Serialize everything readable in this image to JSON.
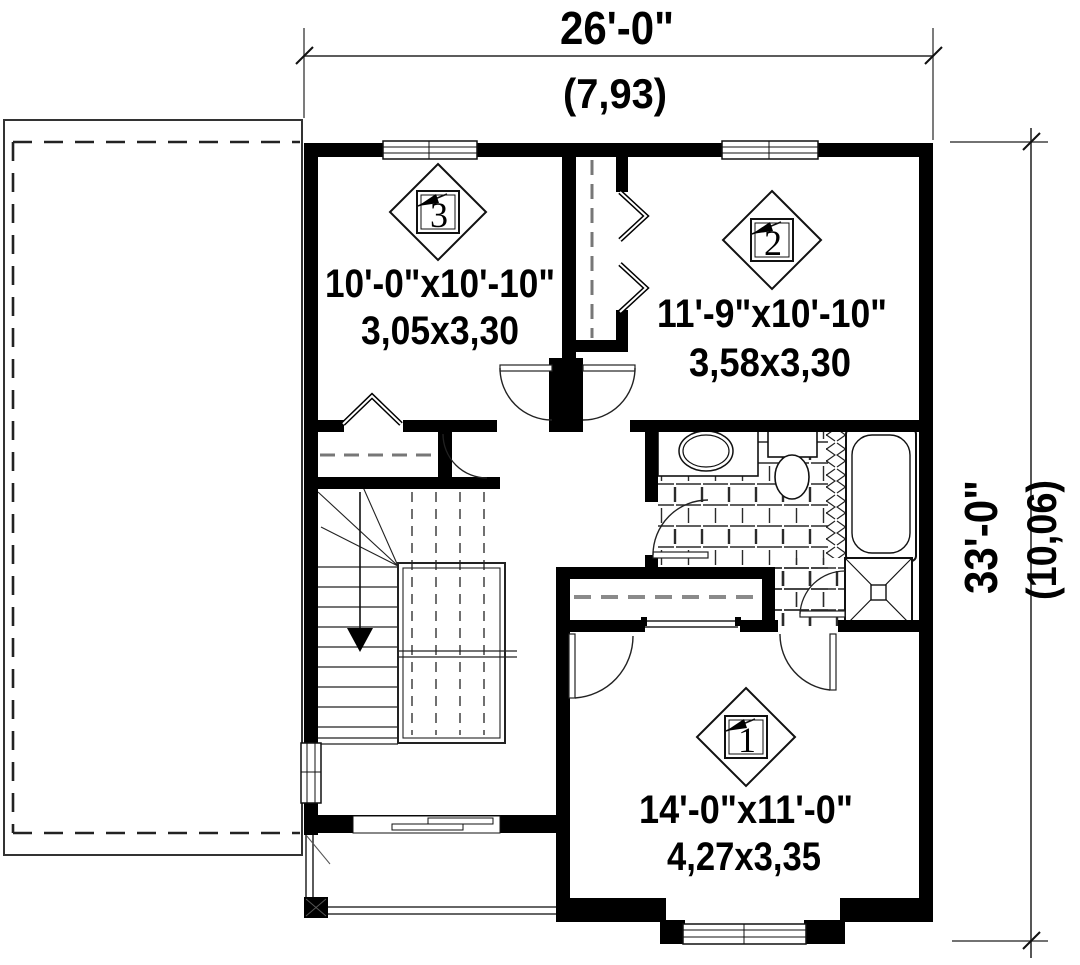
{
  "plan": {
    "title": "second-floor-plan",
    "dimensions": {
      "top_imperial": "26'-0\"",
      "top_metric": "(7,93)",
      "right_imperial": "33'-0\"",
      "right_metric": "(10,06)"
    },
    "rooms": [
      {
        "number": "1",
        "imperial": "14'-0\"x11'-0\"",
        "metric": "4,27x3,35"
      },
      {
        "number": "2",
        "imperial": "11'-9\"x10'-10\"",
        "metric": "3,58x3,30"
      },
      {
        "number": "3",
        "imperial": "10'-0\"x10'-10\"",
        "metric": "3,05x3,30"
      }
    ],
    "colors": {
      "wall": "#000000",
      "line": "#1a1a1a",
      "dash_roof": "#2a2a2a",
      "rod": "#777777",
      "bg": "#ffffff"
    }
  }
}
